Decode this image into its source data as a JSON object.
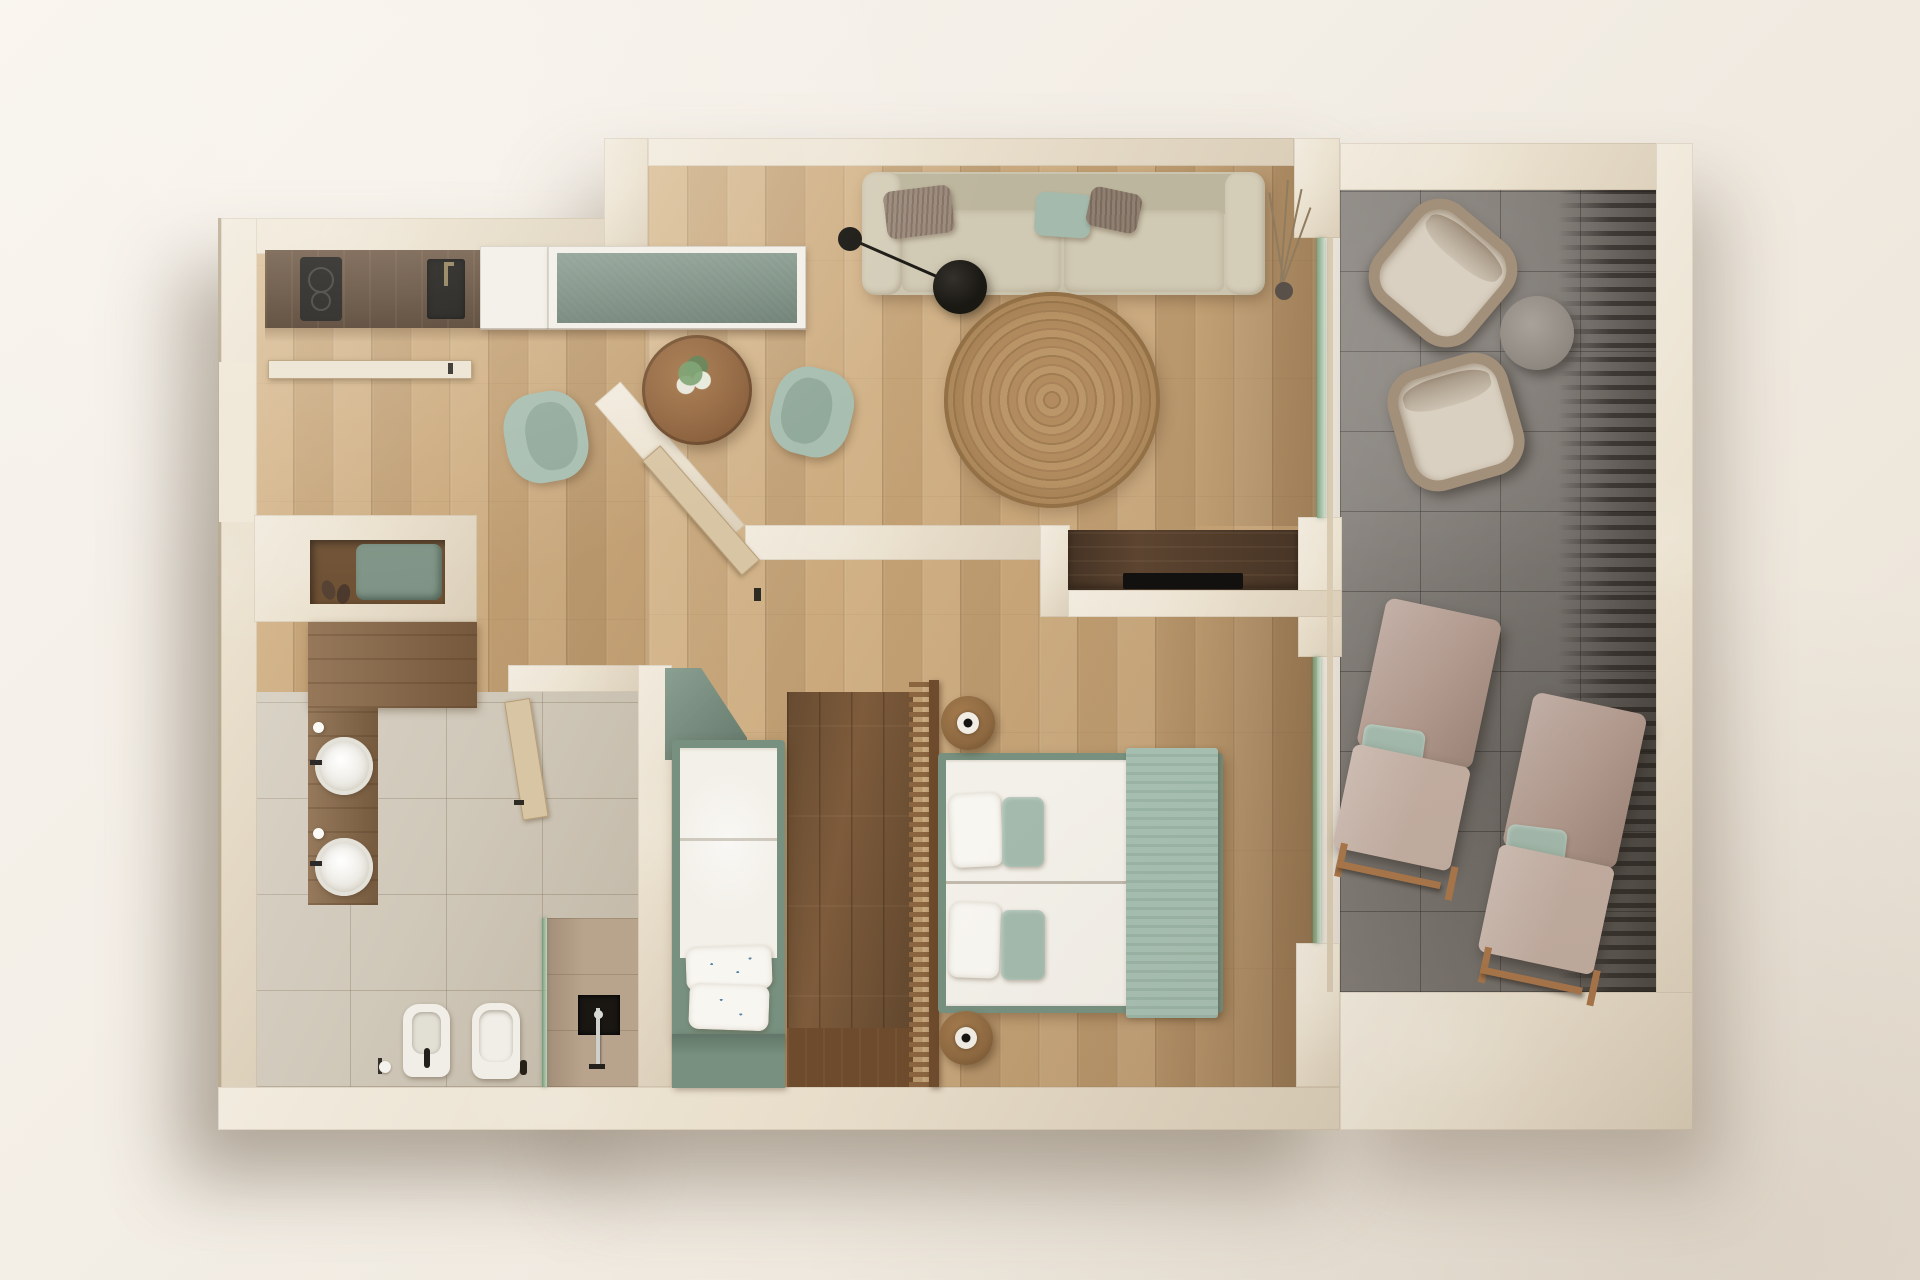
{
  "scene": {
    "type": "3d-floor-plan-top-view",
    "units": "screenshot-pixels",
    "rooms": [
      {
        "id": "kitchen-dining",
        "name": "Kitchen / Dining",
        "floor": "light oak planks"
      },
      {
        "id": "living-room",
        "name": "Living Room",
        "floor": "light oak planks"
      },
      {
        "id": "hallway",
        "name": "Entry Hall / Corridor",
        "floor": "light oak planks"
      },
      {
        "id": "bathroom",
        "name": "Bathroom",
        "floor": "beige stone tiles"
      },
      {
        "id": "single-bedroom",
        "name": "Single Bedroom",
        "floor": "light oak planks"
      },
      {
        "id": "master-bedroom",
        "name": "Master Bedroom",
        "floor": "oak planks with dark aisle"
      },
      {
        "id": "terrace",
        "name": "Terrace",
        "floor": "grey concrete tiles"
      }
    ],
    "furniture": {
      "kitchen-dining": [
        "walnut counter with 2-burner cooktop",
        "black undermount sink with faucet",
        "white cabinet module",
        "sage-green cabinet module with white frame",
        "round wood dining table with flower centerpiece",
        "2 sage dining chairs",
        "entry door",
        "entry bench niche with green cushion and shoes",
        "walnut wardrobe block"
      ],
      "living-room": [
        "beige 2-seat sofa",
        "1 sage pillow",
        "2 taupe fur pillows",
        "black arc floor lamp",
        "round jute rug",
        "dried branch plant in vase",
        "walnut TV console with flat TV"
      ],
      "bathroom": [
        "walnut vanity",
        "2 round white vessel sinks",
        "2 soap dispensers",
        "bidet",
        "toilet",
        "toilet-paper holder",
        "green-tinted glass shower screen",
        "black shower niche",
        "chrome shower column",
        "wood swing door"
      ],
      "single-bedroom": [
        "sage angled wardrobe",
        "single bed with white bedding",
        "2 patterned pillows",
        "sage footboard bench"
      ],
      "master-bedroom": [
        "double bed with white duvets",
        "2 white pillows",
        "2 sage pillows",
        "sage throw at foot",
        "2 round walnut nightstands with disc lamps",
        "vertical wood slat screen",
        "angled pocket door"
      ],
      "terrace": [
        "2 wicker lounge chairs with cream cushions",
        "round concrete side table",
        "2 wooden sun loungers with taupe cushions and mint pillows",
        "louver shadow stripes"
      ]
    },
    "counts": {
      "cooktop_burners": 2,
      "bath_sinks": 2,
      "sofa_pillows": 3,
      "bed_pillows_master": 4,
      "sun_loungers": 2,
      "wicker_chairs": 2,
      "dining_chairs": 2
    }
  },
  "palette": {
    "bg": "#f4efe8",
    "wall": "#eae0cd",
    "wallShade": "#d8cbb2",
    "wood": "#cba97c",
    "woodDark": "#7d5b3b",
    "terrace": "#87827c",
    "bathTile": "#d0c8b9",
    "showerTile": "#b8a48d",
    "counterWalnut": "#5f4733",
    "cabinetWhite": "#f2efe8",
    "cabinetGreen": "#7b9083",
    "applianceBlack": "#191715",
    "tableWood": "#9d7148",
    "chairMint": "#a7beb0",
    "chairMintDark": "#91a99b",
    "sofa": "#cbc5af",
    "sofaDark": "#bdb69e",
    "pillowTaupe": "#9b8a7b",
    "pillowMint": "#a3baac",
    "rug": "#b28c5f",
    "lampBlack": "#1a1813",
    "consoleWood": "#5c4430",
    "tvBlack": "#131110",
    "bedFrameGreen": "#77907f",
    "mattress": "#f3f0e9",
    "throwMint": "#a6bfb1",
    "nightstand": "#8d6840",
    "screenWood": "#8a653f",
    "screenSpine": "#6e4b2c",
    "fixtureWhite": "#f0eee7",
    "vanityWood": "#8a6a49",
    "glassGreen": "#6c9873",
    "doorWood": "#d8c5a4",
    "nicheFloor": "#6f5134",
    "cushionGreen": "#7f9486",
    "wickerFrame": "#a3907a",
    "wickerCushion": "#d9d0c1",
    "sunbedBack": "#b29a8e",
    "sunbedSeat": "#c3aea2",
    "sunbedFrame": "#a9764a",
    "shadow": "rgba(96,80,60,0.45)"
  }
}
